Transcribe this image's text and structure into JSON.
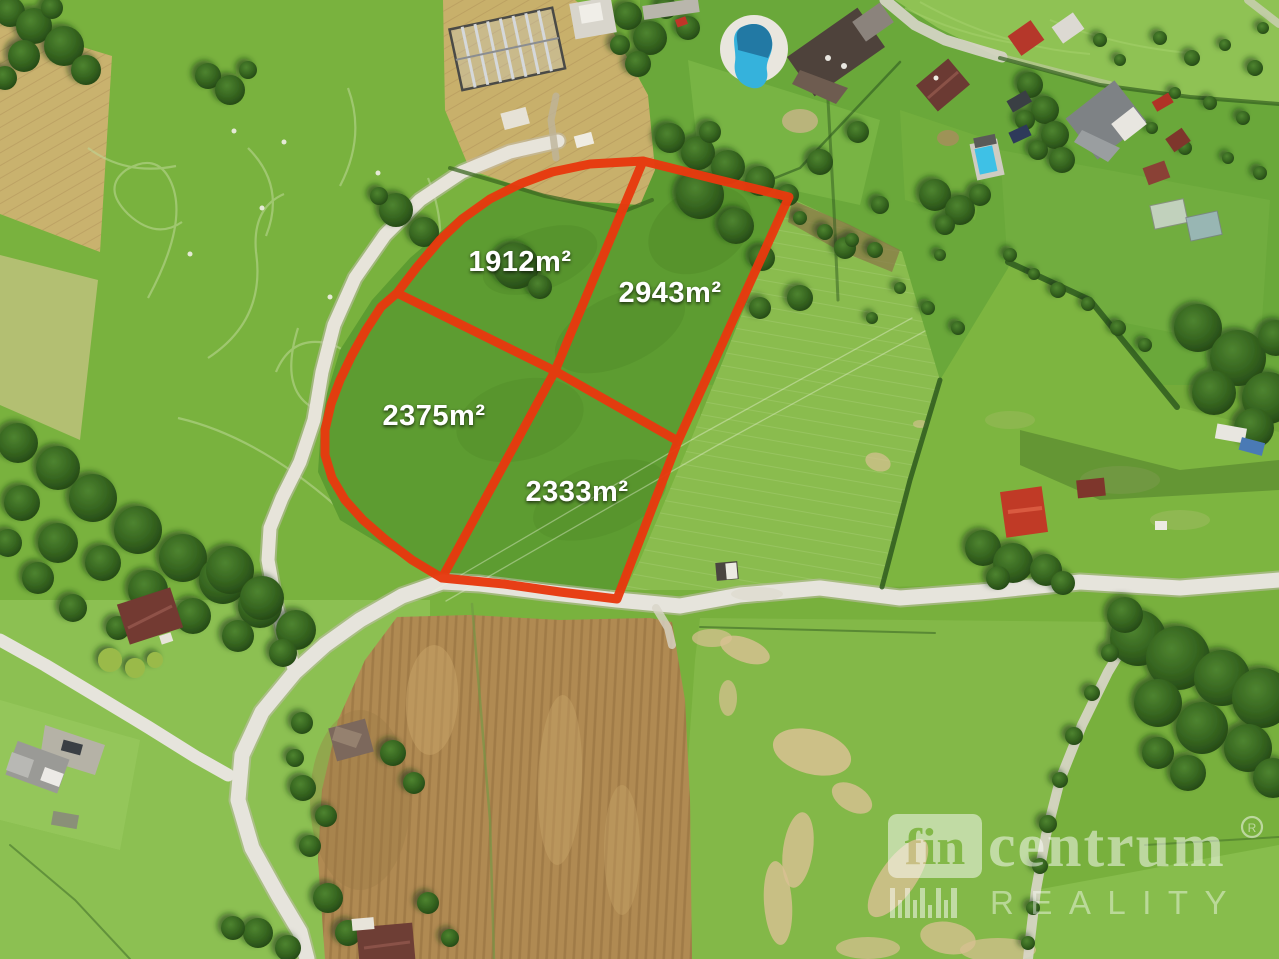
{
  "scene": {
    "type": "aerial-drone-photo",
    "subject": "grass land parcels for sale outlined in red, rural village with roads, houses, pools, fields"
  },
  "parcels": {
    "outline_color": "#e8390e",
    "label_color": "#ffffff",
    "items": [
      {
        "id": "plot-1912",
        "area_label": "1912m²"
      },
      {
        "id": "plot-2943",
        "area_label": "2943m²"
      },
      {
        "id": "plot-2375",
        "area_label": "2375m²"
      },
      {
        "id": "plot-2333",
        "area_label": "2333m²"
      }
    ]
  },
  "watermark": {
    "color": "#ffffff",
    "brand_prefix": "fin",
    "brand_suffix": "centrum",
    "registered_mark": "R",
    "subtitle": "REALITY"
  }
}
